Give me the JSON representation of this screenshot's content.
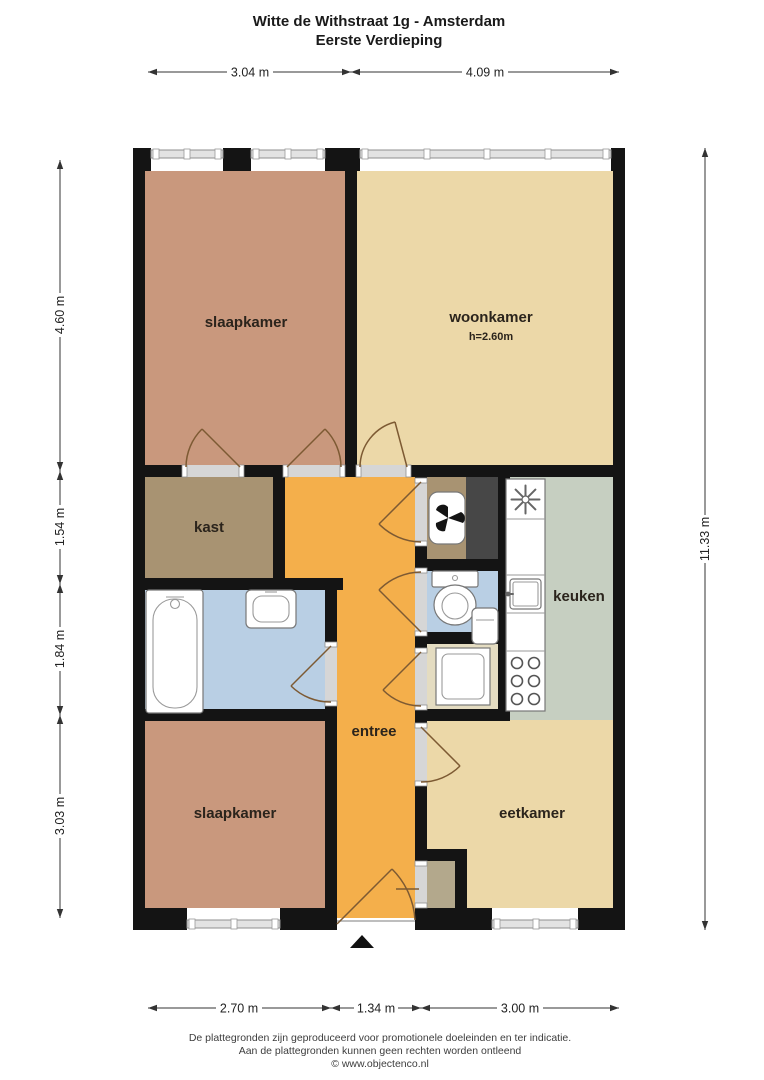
{
  "title": {
    "line1": "Witte de Withstraat 1g - Amsterdam",
    "line2": "Eerste Verdieping"
  },
  "rooms": {
    "slaapkamer_top": {
      "label": "slaapkamer"
    },
    "woonkamer": {
      "label": "woonkamer",
      "ceiling_height": "h=2.60m"
    },
    "kast": {
      "label": "kast"
    },
    "keuken": {
      "label": "keuken"
    },
    "entree": {
      "label": "entree"
    },
    "slaapkamer_bottom": {
      "label": "slaapkamer"
    },
    "eetkamer": {
      "label": "eetkamer"
    }
  },
  "dimensions": {
    "top": [
      {
        "label": "3.04 m"
      },
      {
        "label": "4.09 m"
      }
    ],
    "bottom": [
      {
        "label": "2.70 m"
      },
      {
        "label": "1.34 m"
      },
      {
        "label": "3.00 m"
      }
    ],
    "left": [
      {
        "label": "4.60 m"
      },
      {
        "label": "1.54 m"
      },
      {
        "label": "1.84 m"
      },
      {
        "label": "3.03 m"
      }
    ],
    "right": [
      {
        "label": "11.33 m"
      }
    ]
  },
  "footer": {
    "disclaimer1": "De plattegronden zijn geproduceerd voor promotionele doeleinden en ter indicatie.",
    "disclaimer2": "Aan de plattegronden kunnen geen rechten worden ontleend",
    "copyright": "© www.objectenco.nl"
  },
  "colors": {
    "wall": "#141414",
    "slaapkamer": "#c9987d",
    "woonkamer": "#ecd8a8",
    "eetkamer": "#ecd8a8",
    "kast": "#a89372",
    "mv_room": "#a89372",
    "entree": "#f4af4b",
    "keuken": "#c6cfc1",
    "bathroom": "#b9cfe4",
    "toilet": "#b9cfe4",
    "washer_room": "#e4dcc1",
    "closet": "#b3a88c",
    "shaft": "#474747",
    "window": "#e3e3e3",
    "door": "#7d5a33",
    "dimension": "#333333"
  }
}
